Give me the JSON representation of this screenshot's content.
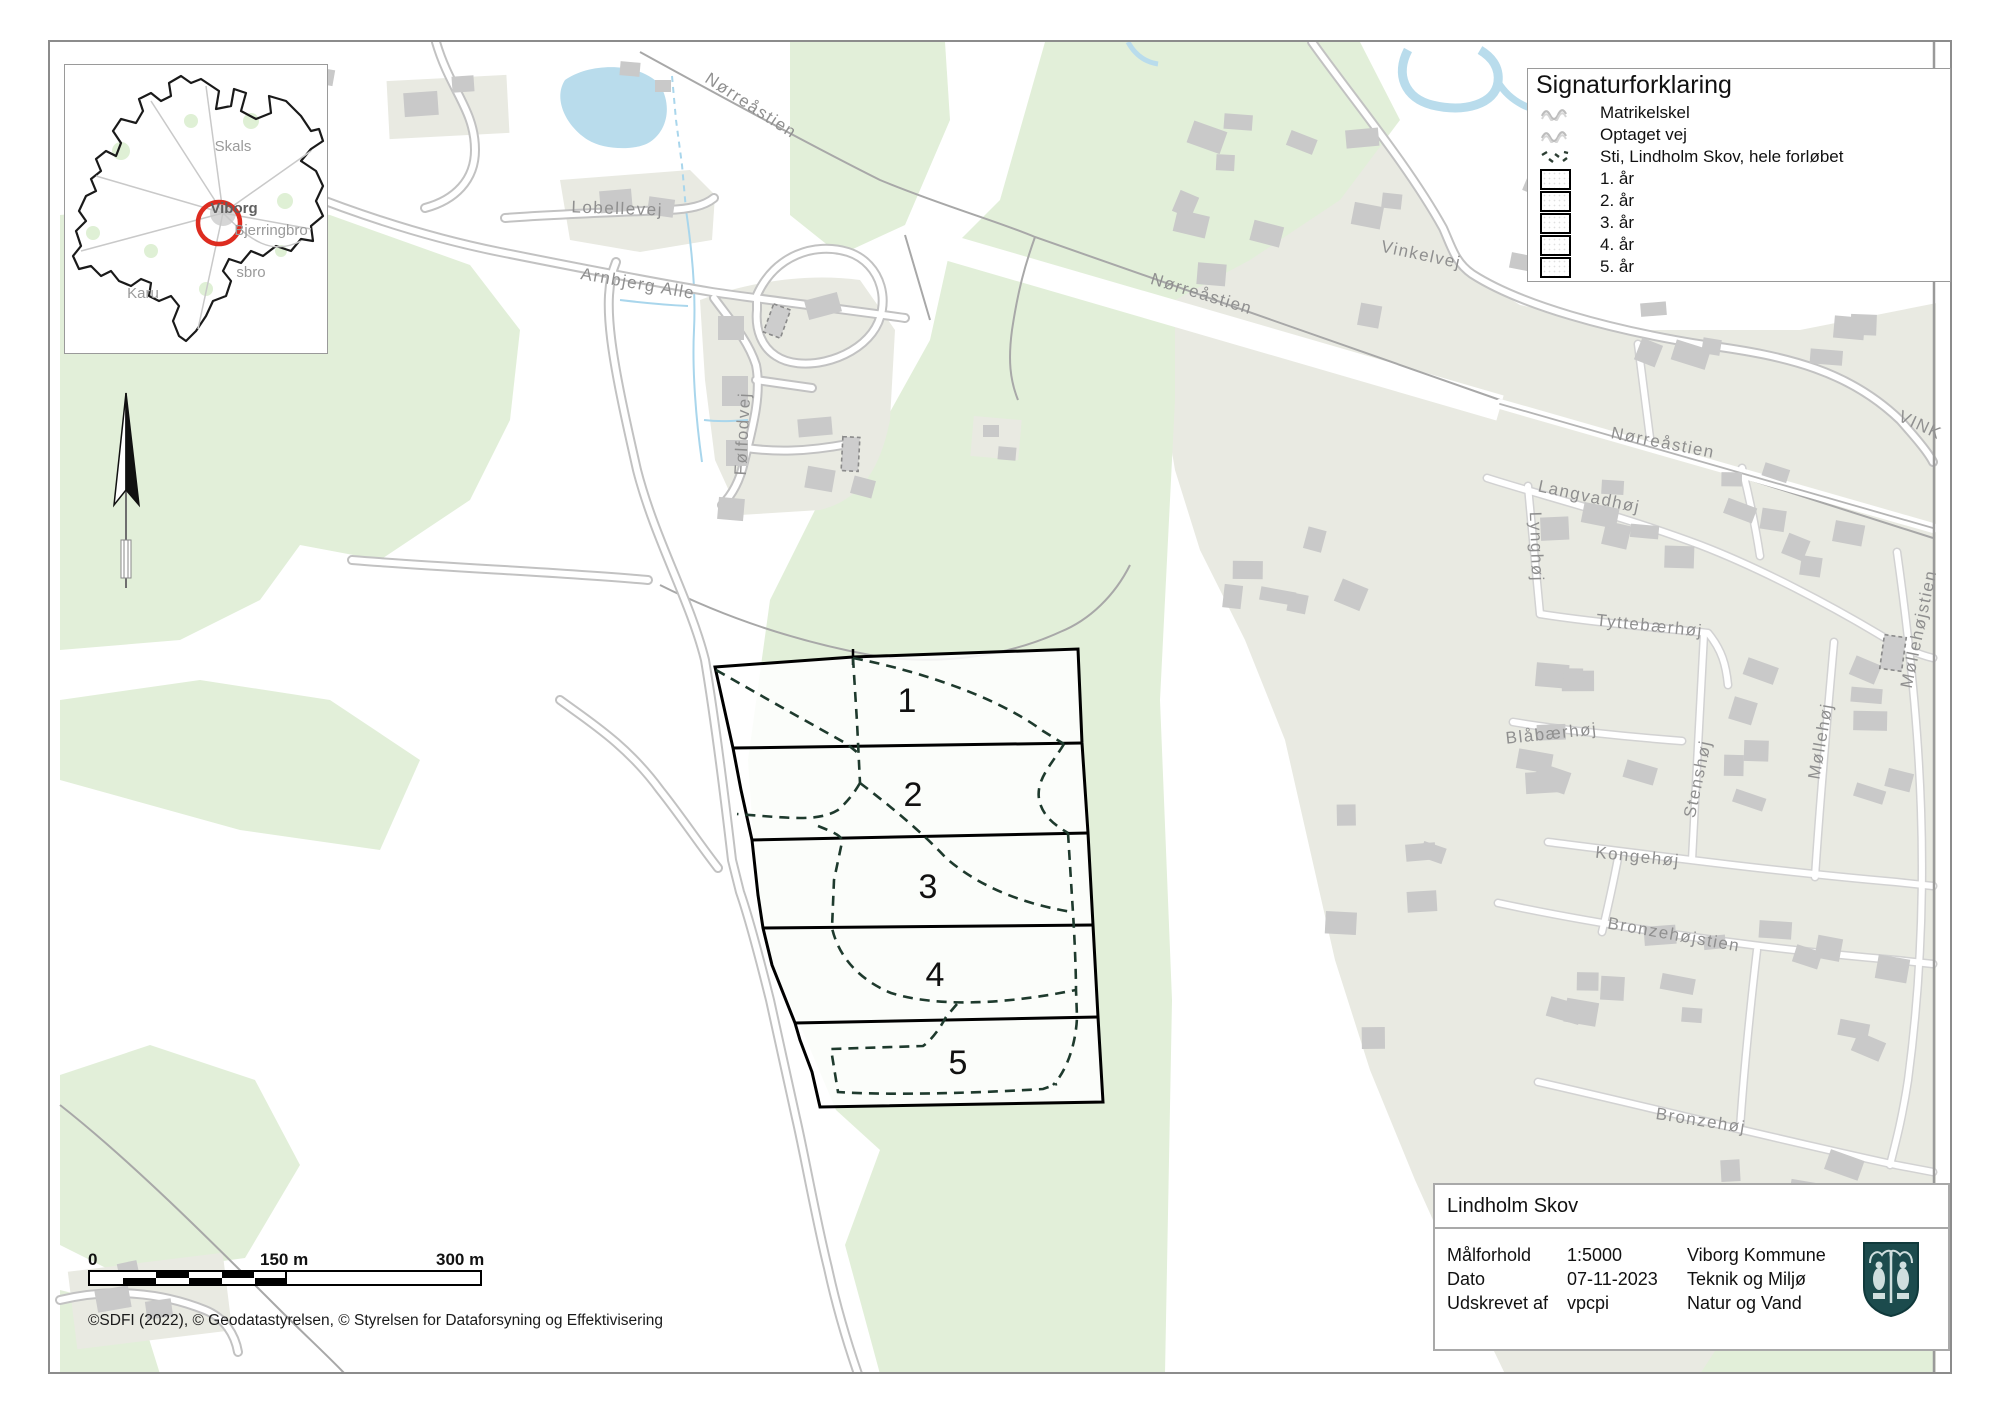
{
  "colors": {
    "green": "#e2efd9",
    "beige": "#e9eae2",
    "building": "#c9c9c9",
    "road_casing": "#c2c2c2",
    "gray_path": "#a8a8a8",
    "water": "#b9dcec",
    "label_gray": "#8f8f8f",
    "parcel_stroke": "#000000",
    "dashed_path": "#1e3a2d",
    "red_circle": "#dd2c20",
    "shield": "#1c4b4d"
  },
  "legend": {
    "title": "Signaturforklaring",
    "items": [
      {
        "icon": "wavy-gray-icon",
        "label": "Matrikelskel"
      },
      {
        "icon": "wavy-gray-icon",
        "label": "Optaget vej"
      },
      {
        "icon": "dashed-path-icon",
        "label": "Sti, Lindholm Skov, hele forløbet"
      },
      {
        "icon": "area-swatch",
        "label": "1. år"
      },
      {
        "icon": "area-swatch",
        "label": "2. år"
      },
      {
        "icon": "area-swatch",
        "label": "3. år"
      },
      {
        "icon": "area-swatch",
        "label": "4. år"
      },
      {
        "icon": "area-swatch",
        "label": "5. år"
      }
    ]
  },
  "info_box": {
    "title": "Lindholm Skov",
    "rows": [
      {
        "label": "Målforhold",
        "value": "1:5000"
      },
      {
        "label": "Dato",
        "value": "07-11-2023"
      },
      {
        "label": "Udskrevet af",
        "value": "vpcpi"
      }
    ],
    "org_lines": [
      "Viborg Kommune",
      "Teknik og Miljø",
      "Natur og Vand"
    ]
  },
  "scale_bar": {
    "ticks": [
      "0",
      "150 m",
      "300 m"
    ]
  },
  "attribution": "©SDFI (2022), © Geodatastyrelsen, © Styrelsen for Dataforsyning og Effektivisering",
  "parcels": {
    "numbers": [
      {
        "text": "1",
        "x": 907,
        "y": 712
      },
      {
        "text": "2",
        "x": 913,
        "y": 806
      },
      {
        "text": "3",
        "x": 928,
        "y": 898
      },
      {
        "text": "4",
        "x": 935,
        "y": 986
      },
      {
        "text": "5",
        "x": 958,
        "y": 1074
      }
    ]
  },
  "street_labels": [
    {
      "text": "Nørreåstien",
      "x": 748,
      "y": 110,
      "rot": 33
    },
    {
      "text": "Lobellevej",
      "x": 617,
      "y": 214,
      "rot": 2
    },
    {
      "text": "Arnbjerg Alle",
      "x": 637,
      "y": 289,
      "rot": 10
    },
    {
      "text": "Følfodvej",
      "x": 748,
      "y": 434,
      "rot": -87
    },
    {
      "text": "Nørreåstien",
      "x": 1200,
      "y": 299,
      "rot": 17
    },
    {
      "text": "Vinkelvej",
      "x": 1420,
      "y": 260,
      "rot": 12
    },
    {
      "text": "VINK",
      "x": 1918,
      "y": 430,
      "rot": 25
    },
    {
      "text": "Nørreåstien",
      "x": 1662,
      "y": 448,
      "rot": 11
    },
    {
      "text": "Langvadhøj",
      "x": 1588,
      "y": 502,
      "rot": 12
    },
    {
      "text": "Lynghøj",
      "x": 1531,
      "y": 547,
      "rot": 88
    },
    {
      "text": "Tyttebærhøj",
      "x": 1649,
      "y": 631,
      "rot": 6
    },
    {
      "text": "Blåbærhøj",
      "x": 1552,
      "y": 739,
      "rot": -6
    },
    {
      "text": "Stenshøj",
      "x": 1703,
      "y": 780,
      "rot": -78
    },
    {
      "text": "Møllehøj",
      "x": 1826,
      "y": 742,
      "rot": -80
    },
    {
      "text": "Kongehøj",
      "x": 1637,
      "y": 862,
      "rot": 6
    },
    {
      "text": "Bronzehøjstien",
      "x": 1673,
      "y": 940,
      "rot": 10
    },
    {
      "text": "Bronzehøj",
      "x": 1700,
      "y": 1126,
      "rot": 9
    },
    {
      "text": "Møllehøjstien",
      "x": 1924,
      "y": 630,
      "rot": -78
    }
  ],
  "inset": {
    "labels": [
      {
        "text": "Skals",
        "x": 232,
        "y": 150,
        "bold": false
      },
      {
        "text": "Viborg",
        "x": 233,
        "y": 212,
        "bold": true
      },
      {
        "text": "Bjerringbro",
        "x": 270,
        "y": 234,
        "bold": false
      },
      {
        "text": "sbro",
        "x": 250,
        "y": 276,
        "bold": false
      },
      {
        "text": "Karu",
        "x": 142,
        "y": 297,
        "bold": false
      }
    ]
  }
}
